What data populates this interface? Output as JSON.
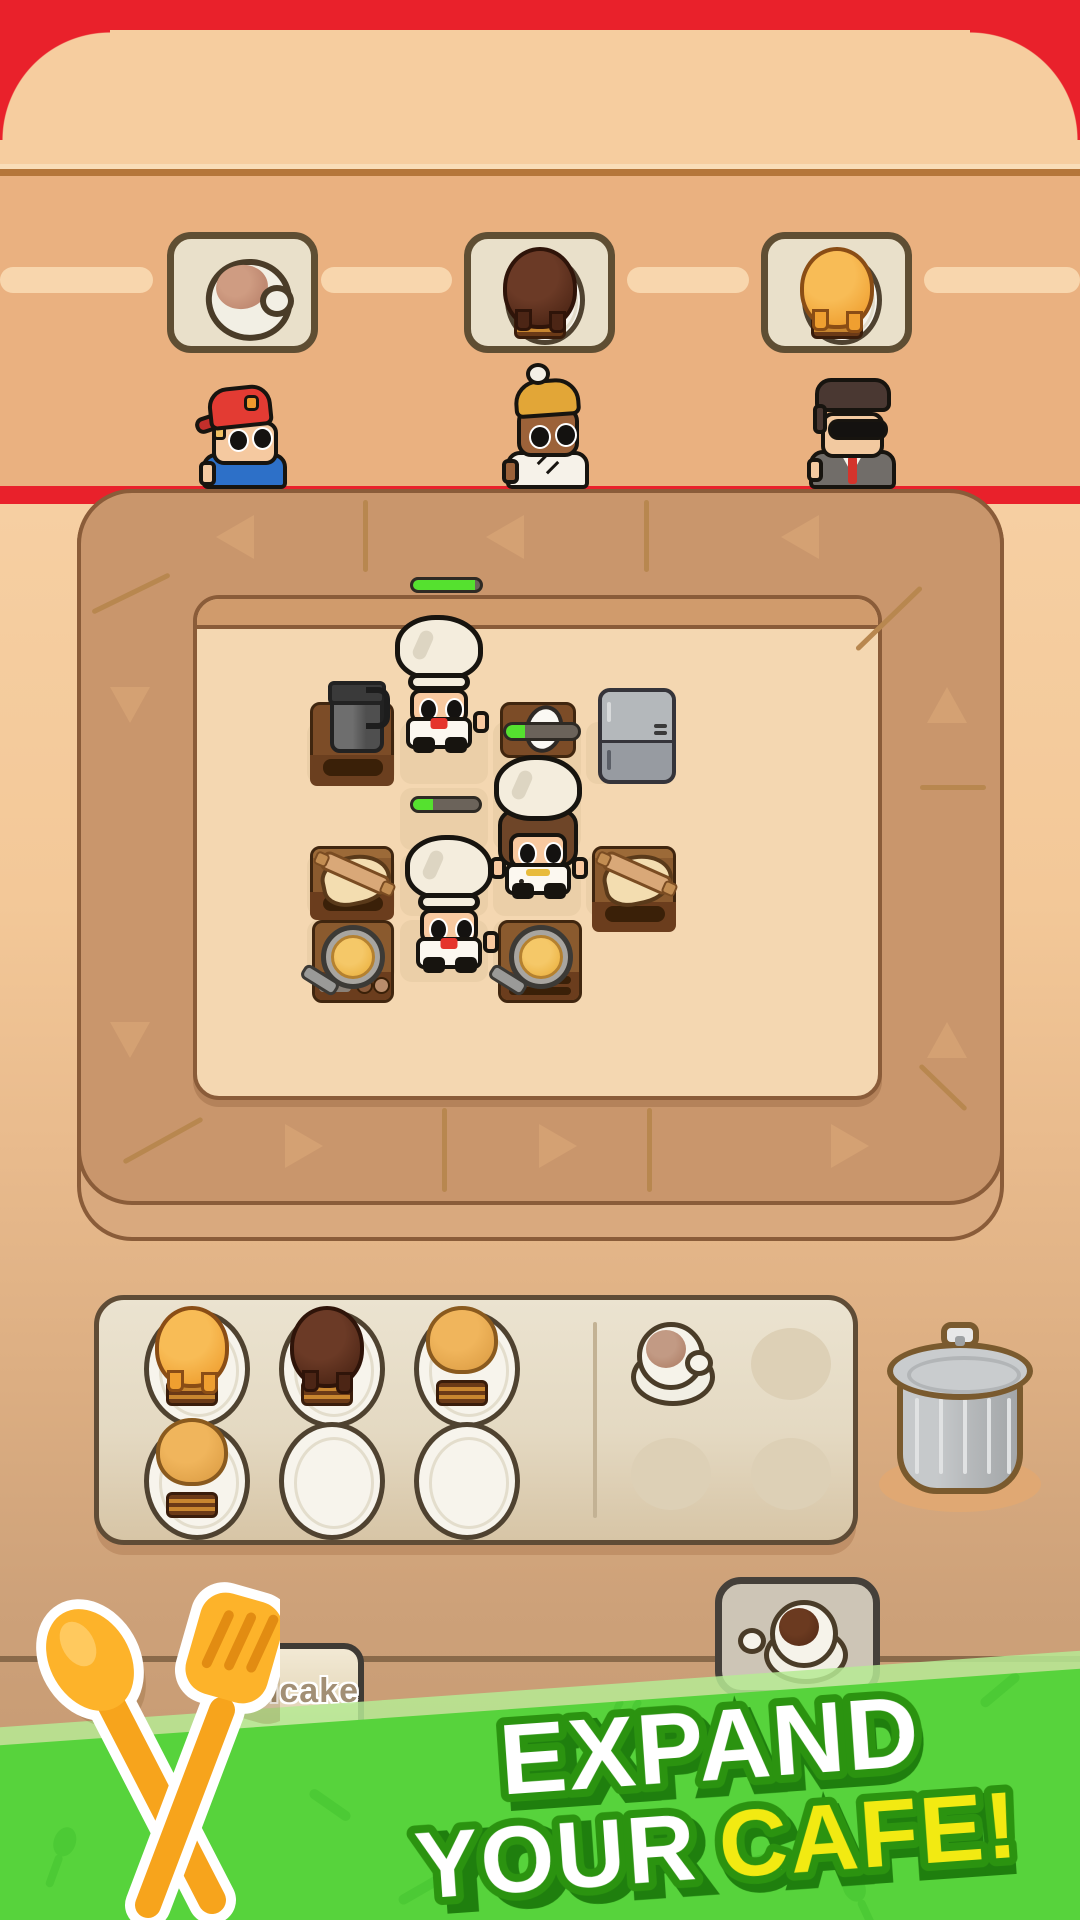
{
  "statusbar": {
    "color": "#e9212b"
  },
  "orders": {
    "cards": [
      {
        "item": "coffee",
        "icon": "coffee-cup-icon"
      },
      {
        "item": "chocolate-pancake",
        "icon": "chocolate-pancake-icon"
      },
      {
        "item": "honey-pancake",
        "icon": "honey-pancake-icon"
      }
    ]
  },
  "customers": [
    {
      "id": "boy-red-cap",
      "desc": "boy with red backwards cap and blue shirt"
    },
    {
      "id": "woman-yellow-beanie",
      "desc": "customer with yellow pompom beanie and white shirt"
    },
    {
      "id": "man-suit",
      "desc": "businessman with sunglasses, gray suit and red tie"
    }
  ],
  "kitchen": {
    "progress_bars": [
      {
        "id": "order-top",
        "percent": 93,
        "x": 410,
        "y": 577,
        "w": 73,
        "h": 16
      },
      {
        "id": "egg-table",
        "percent": 27,
        "x": 503,
        "y": 722,
        "w": 78,
        "h": 19
      },
      {
        "id": "order-middle",
        "percent": 30,
        "x": 410,
        "y": 796,
        "w": 72,
        "h": 17
      }
    ],
    "stations": [
      "coffee-machine",
      "egg-prep-table",
      "fridge",
      "dough-table-left",
      "stove-left",
      "stove-middle",
      "dough-table-right"
    ],
    "chefs": [
      {
        "id": "chef-top",
        "type": "white-chef-red-bow"
      },
      {
        "id": "chef-middle",
        "type": "female-chef-brown-hair"
      },
      {
        "id": "chef-bottom",
        "type": "white-chef-red-bow"
      }
    ],
    "ring": {
      "arrows": [
        {
          "x": 235,
          "y": 537,
          "dir": "left"
        },
        {
          "x": 505,
          "y": 537,
          "dir": "left"
        },
        {
          "x": 800,
          "y": 537,
          "dir": "left"
        },
        {
          "x": 304,
          "y": 1146,
          "dir": "right"
        },
        {
          "x": 558,
          "y": 1146,
          "dir": "right"
        },
        {
          "x": 850,
          "y": 1146,
          "dir": "right"
        },
        {
          "x": 130,
          "y": 705,
          "dir": "down"
        },
        {
          "x": 130,
          "y": 1040,
          "dir": "down"
        },
        {
          "x": 947,
          "y": 705,
          "dir": "up"
        },
        {
          "x": 947,
          "y": 1040,
          "dir": "up"
        }
      ],
      "ticks": [
        {
          "x": 363,
          "y": 500,
          "len": 72,
          "horiz": false
        },
        {
          "x": 644,
          "y": 500,
          "len": 72,
          "horiz": false
        },
        {
          "x": 442,
          "y": 1108,
          "len": 84,
          "horiz": false
        },
        {
          "x": 647,
          "y": 1108,
          "len": 84,
          "horiz": false
        },
        {
          "x": 920,
          "y": 785,
          "len": 66,
          "horiz": true
        }
      ],
      "slashes": [
        {
          "x": 131,
          "y": 591,
          "len": 86,
          "deg": -26
        },
        {
          "x": 889,
          "y": 616,
          "len": 90,
          "deg": -44
        },
        {
          "x": 163,
          "y": 1138,
          "len": 90,
          "deg": -29
        },
        {
          "x": 943,
          "y": 1085,
          "len": 64,
          "deg": 44
        }
      ],
      "tiles": [
        [
          307,
          722
        ],
        [
          400,
          722
        ],
        [
          493,
          722
        ],
        [
          586,
          722
        ],
        [
          400,
          788
        ],
        [
          493,
          788
        ],
        [
          307,
          854
        ],
        [
          400,
          854
        ],
        [
          493,
          854
        ],
        [
          586,
          854
        ],
        [
          307,
          920
        ],
        [
          400,
          920
        ],
        [
          493,
          920
        ]
      ]
    }
  },
  "counter": {
    "left_plates": [
      [
        "honey-pancake",
        "chocolate-pancake",
        "plain-pancake"
      ],
      [
        "plain-pancake",
        "empty",
        "empty"
      ]
    ],
    "right_spots": [
      [
        "coffee-cup",
        "empty"
      ],
      [
        "empty",
        "empty"
      ]
    ]
  },
  "trash": {
    "id": "trash-can"
  },
  "buttons": {
    "pancake": {
      "label": "Pancake"
    },
    "coffee": {
      "icon": "coffee-cup-icon"
    }
  },
  "banner": {
    "line1": "EXPAND",
    "line2_white": "YOUR",
    "line2_accent": "CAFE!",
    "green": "#57d33c",
    "accent_color": "#f2ea12",
    "pattern": [
      {
        "x": 620,
        "y": 175,
        "type": "steam",
        "rot": 0
      },
      {
        "x": 1000,
        "y": 130,
        "type": "bar",
        "rot": -40
      },
      {
        "x": 60,
        "y": 295,
        "type": "spoon",
        "rot": 20
      },
      {
        "x": 420,
        "y": 330,
        "type": "bar",
        "rot": -30
      },
      {
        "x": 960,
        "y": 290,
        "type": "steam",
        "rot": 10
      },
      {
        "x": 860,
        "y": 340,
        "type": "spoon",
        "rot": -25
      },
      {
        "x": 330,
        "y": 245,
        "type": "bar",
        "rot": 35
      },
      {
        "x": 760,
        "y": 300,
        "type": "bar",
        "rot": -15
      }
    ]
  }
}
